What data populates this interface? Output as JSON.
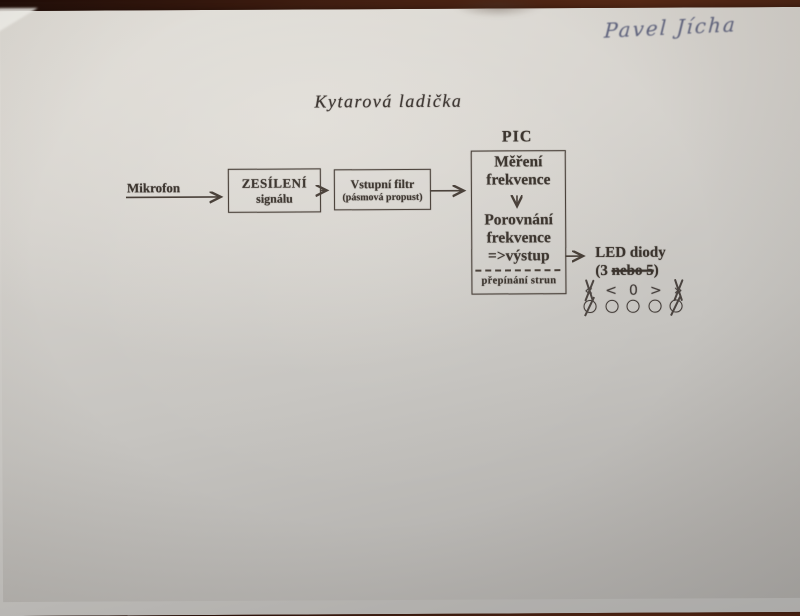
{
  "photo": {
    "desk_color": "#3f1d10",
    "paper_color": "#cfccc7",
    "ink_color": "#39322c",
    "pen_ink_color": "#484e6e"
  },
  "handwriting": {
    "name": "Pavel Jícha"
  },
  "title": "Kytarová ladička",
  "diagram": {
    "mikrofon_label": "Mikrofon",
    "amplifier_box": {
      "line1": "ZESÍLENÍ",
      "line2": "signálu"
    },
    "filter_box": {
      "line1": "Vstupní filtr",
      "line2": "(pásmová propust)"
    },
    "pic_box": {
      "title": "PIC",
      "block1_line1": "Měření",
      "block1_line2": "frekvence",
      "block2_line1": "Porovnání",
      "block2_line2": "frekvence",
      "block2_line3": "=>výstup",
      "bottom_label": "přepínání strun"
    },
    "led_section": {
      "title": "LED diody",
      "count_prefix": "(3 ",
      "count_struck": "nebo 5",
      "count_suffix": ")",
      "symbols": [
        {
          "glyph": "«",
          "crossed": true
        },
        {
          "glyph": "<",
          "crossed": false
        },
        {
          "glyph": "0",
          "crossed": false
        },
        {
          "glyph": ">",
          "crossed": false
        },
        {
          "glyph": "»",
          "crossed": true
        }
      ],
      "leds": [
        {
          "crossed": true
        },
        {
          "crossed": false
        },
        {
          "crossed": false
        },
        {
          "crossed": false
        },
        {
          "crossed": true
        }
      ]
    }
  }
}
